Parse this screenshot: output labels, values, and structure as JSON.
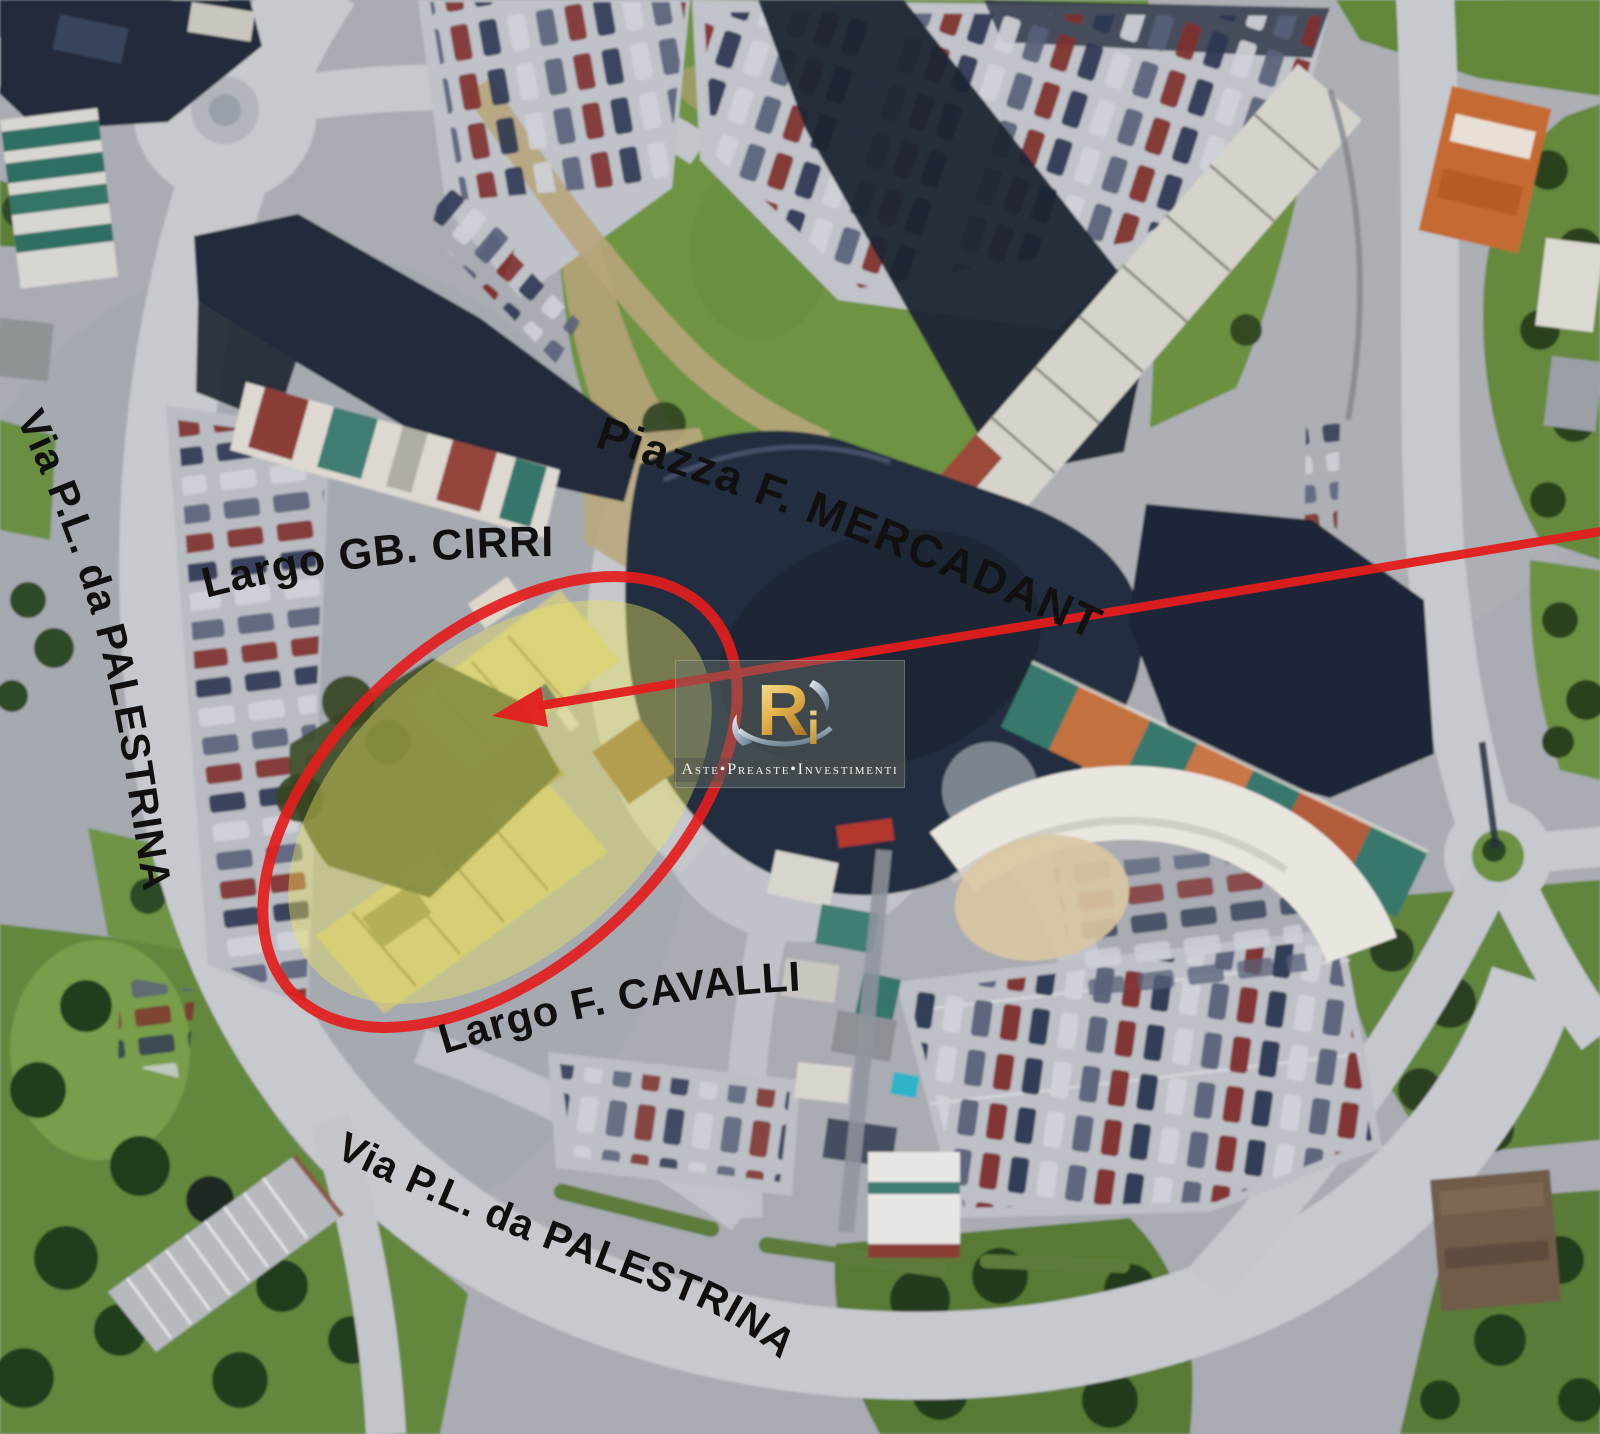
{
  "map": {
    "street_labels": {
      "via_palestrina_left": "Via P.L. da PALESTRINA",
      "largo_gb_cirri": "Largo GB. CIRRI",
      "piazza_f_mercadante": "Piazza F. MERCADANTE",
      "largo_f_cavalli": "Largo F. CAVALLI",
      "via_palestrina_bottom": "Via P.L. da PALESTRINA"
    }
  },
  "annotations": {
    "highlight_fill": "#ece460",
    "ellipse_stroke": "#e31d1d",
    "arrow_color": "#e31d1d"
  },
  "watermark": {
    "logo_main": "R",
    "logo_accent": "i",
    "tagline": "Aste•Preaste•Investimenti"
  }
}
